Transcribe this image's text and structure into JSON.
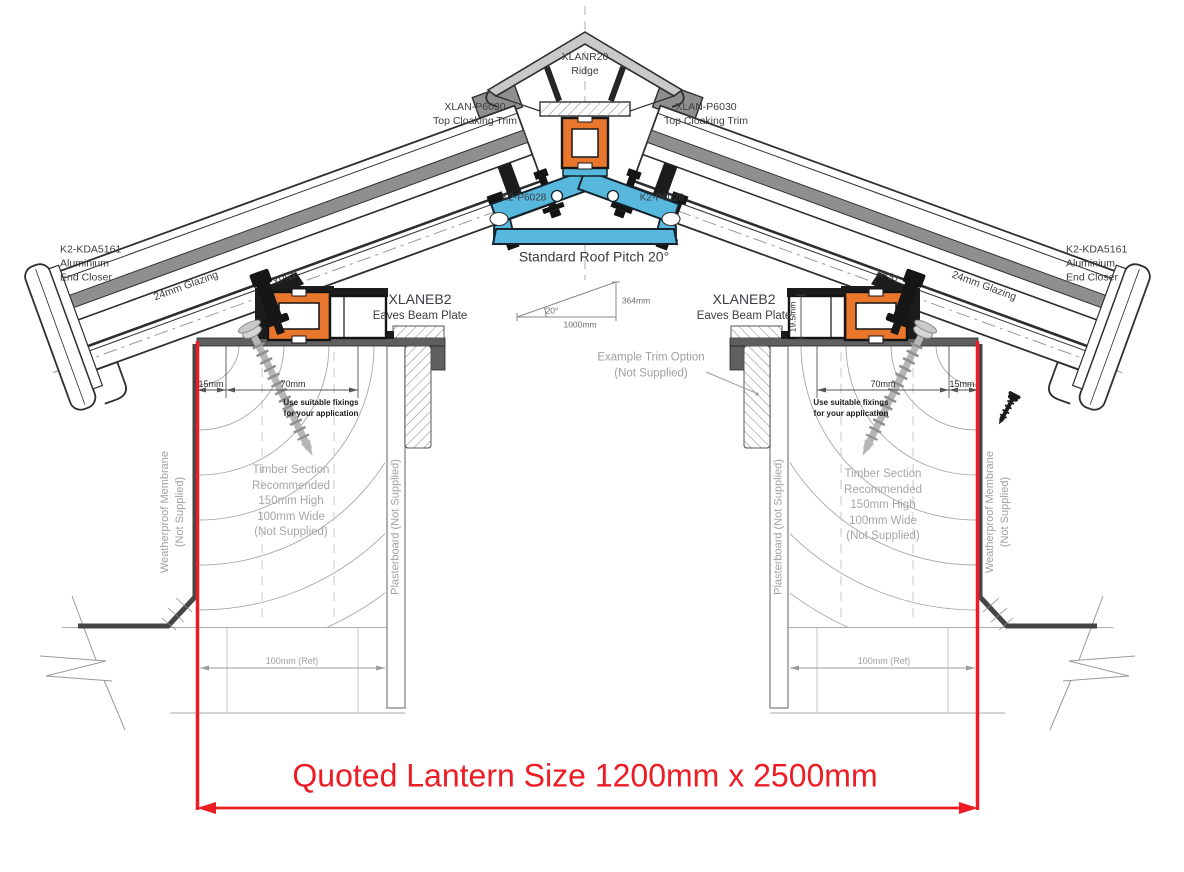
{
  "labels": {
    "ridge": "XLANR20\nRidge",
    "top_cloaking_trim": "XLAN-P6030\nTop Cloaking Trim",
    "ridge_bar_fixing": "K2-P6028",
    "end_closer": "K2-KDA5161\nAluminium\nEnd Closer",
    "glazing": "24mm Glazing",
    "xps1": "XPS1",
    "eaves_beam_code": "XLANEB2",
    "eaves_beam_name": "Eaves Beam Plate",
    "roof_pitch": "Standard Roof Pitch 20°"
  },
  "dimensions": {
    "pitch_angle": "20°",
    "pitch_rise": "364mm",
    "pitch_run": "1000mm",
    "edge_offset": "15mm",
    "fixing_zone": "70mm",
    "plate_height": "19.5mm",
    "timber_ref": "100mm (Ref)"
  },
  "notes": {
    "fixings": "Use suitable fixings\nfor your application",
    "timber": "Timber Section\nRecommended\n150mm High\n100mm Wide\n(Not Supplied)",
    "membrane": "Weatherproof Membrane\n(Not Supplied)",
    "plasterboard": "Plasterboard (Not Supplied)",
    "trim_option": "Example  Trim Option\n(Not Supplied)"
  },
  "quoted_size": "Quoted Lantern Size 1200mm x 2500mm",
  "colors": {
    "dimension_red": "#ed1c24",
    "thermal_break_orange": "#e8762c",
    "glazing_bar_blue": "#57b7dc"
  }
}
